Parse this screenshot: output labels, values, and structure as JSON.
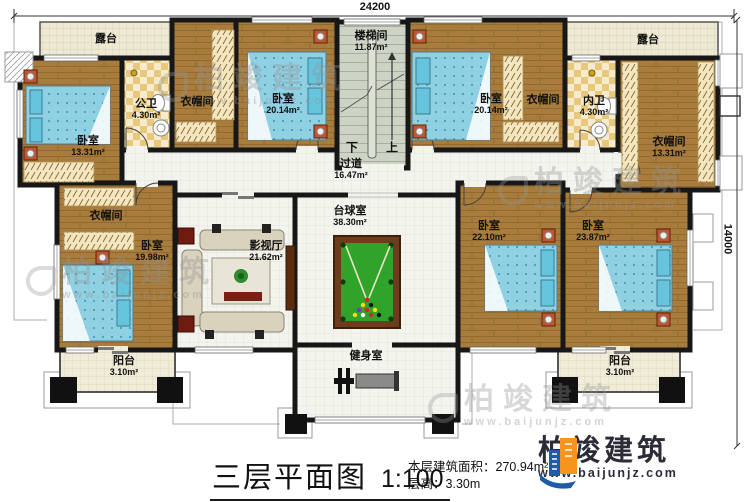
{
  "plan": {
    "dim_top": "24200",
    "dim_right": "14000",
    "stairs": {
      "down": "下",
      "up": "上"
    }
  },
  "rooms": {
    "terrace_left": {
      "name": "露台",
      "area": ""
    },
    "terrace_right": {
      "name": "露台",
      "area": ""
    },
    "bedroom_1": {
      "name": "卧室",
      "area": "13.31m²"
    },
    "bath_public": {
      "name": "公卫",
      "area": "4.30m²"
    },
    "cloak_top_left": {
      "name": "衣帽间",
      "area": ""
    },
    "bedroom_2": {
      "name": "卧室",
      "area": "20.14m²"
    },
    "stairwell": {
      "name": "楼梯间",
      "area": "11.87m²"
    },
    "bedroom_3": {
      "name": "卧室",
      "area": "20.14m²"
    },
    "cloak_top_right": {
      "name": "衣帽间",
      "area": ""
    },
    "bath_private": {
      "name": "内卫",
      "area": "4.30m²"
    },
    "cloak_right": {
      "name": "衣帽间",
      "area": "13.31m²"
    },
    "corridor": {
      "name": "过道",
      "area": "16.47m²"
    },
    "cloak_mid_left": {
      "name": "衣帽间",
      "area": ""
    },
    "bedroom_4": {
      "name": "卧室",
      "area": "19.98m²"
    },
    "theater": {
      "name": "影视厅",
      "area": "21.62m²"
    },
    "billiards": {
      "name": "台球室",
      "area": "38.30m²"
    },
    "bedroom_5": {
      "name": "卧室",
      "area": "22.10m²"
    },
    "bedroom_6": {
      "name": "卧室",
      "area": "23.87m²"
    },
    "balcony_left": {
      "name": "阳台",
      "area": "3.10m²"
    },
    "gym": {
      "name": "健身室",
      "area": ""
    },
    "balcony_right": {
      "name": "阳台",
      "area": "3.10m²"
    }
  },
  "titleblock": {
    "title": "三层平面图",
    "scale": "1:100",
    "area_label": "本层建筑面积：",
    "area_value": "270.94m²",
    "height_label": "层高：",
    "height_value": "3.30m"
  },
  "logo": {
    "brand": "柏竣建筑",
    "url": "www.baijunjz.com"
  },
  "watermark": {
    "brand": "柏竣建筑",
    "url": "www.baijunjz.com"
  },
  "colors": {
    "wall": "#171717",
    "wood_floor": "#a87c3c",
    "tile_floor": "#f4f4ef",
    "terrace_floor": "#eee9d3",
    "stair_floor": "#cdd4c6",
    "bed_blue": "#8fd0e2",
    "pool_felt": "#2fa32a",
    "logo_blue": "#1e5ca8",
    "logo_orange": "#f7941d"
  }
}
